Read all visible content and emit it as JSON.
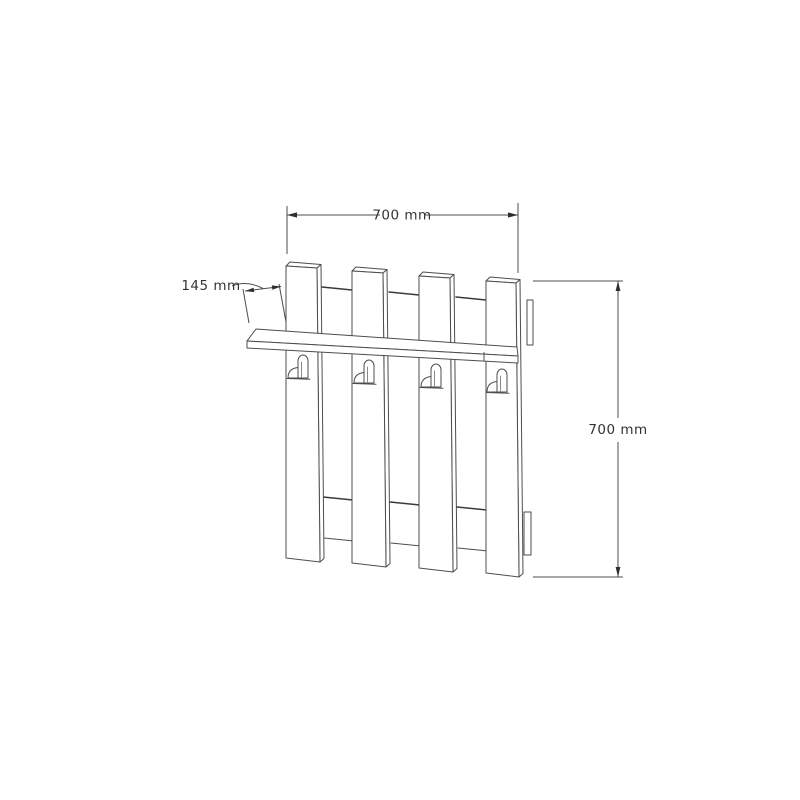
{
  "drawing": {
    "kind": "furniture dimension drawing",
    "object": {
      "planks": 4,
      "hooks": 4,
      "shelves": 1,
      "back_rails": 2
    },
    "dimensions": {
      "width": {
        "label": "700 mm"
      },
      "height": {
        "label": "700 mm"
      },
      "shelf_depth": {
        "label": "145 mm"
      }
    },
    "colors": {
      "line": "#4d4d4d",
      "rail_line": "#3a3a3a",
      "text": "#333333",
      "background": "#ffffff"
    }
  }
}
